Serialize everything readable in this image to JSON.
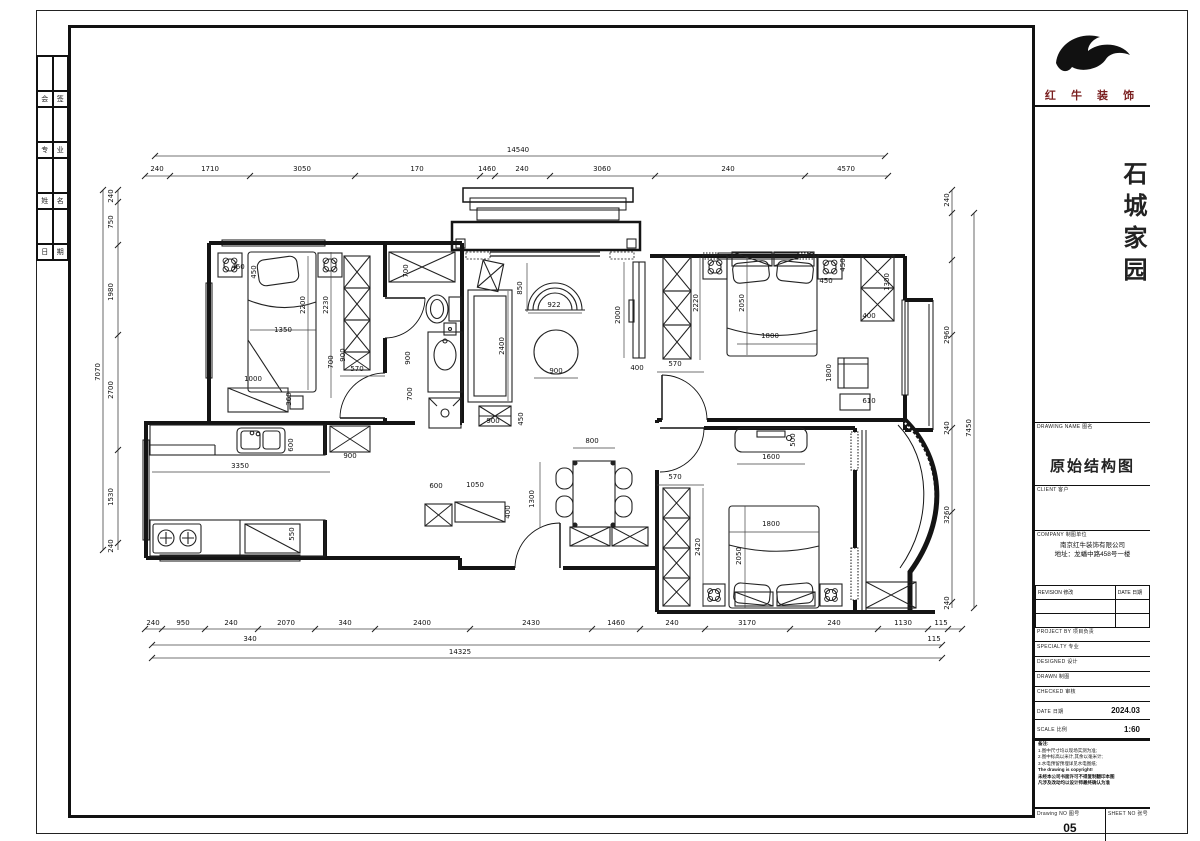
{
  "title_block": {
    "brand": "红 牛 装 饰",
    "project_name": "石城家园",
    "drawing_name_label": "DRAWING NAME 图名",
    "drawing_name": "原始结构图",
    "client_label": "CLIENT 客户",
    "company_label": "COMPANY 制图单位",
    "company_lines": [
      "南京红牛装饰有限公司",
      "地址：龙蟠中路458号一楼"
    ],
    "rev_header_left": "REVISION 修改",
    "rev_header_right": "DATE 日期",
    "info_rows": [
      {
        "label": "PROJECT BY 项目负责"
      },
      {
        "label": "SPECIALTY 专业"
      },
      {
        "label": "DESIGNED 设计"
      },
      {
        "label": "DRAWN 制图"
      },
      {
        "label": "CHECKED 审核"
      }
    ],
    "date_label": "DATE 日期",
    "date_value": "2024.03",
    "scale_label": "SCALE 比例",
    "scale_value": "1:60",
    "notes_lines": [
      "备注:",
      "1.图中尺寸均以现场实测为准;",
      "2.图中标高以米计,其余以毫米计;",
      "3.水电预留预埋详见水电图纸;",
      "The drawing is copyright!",
      "未经本公司书面许可不得复制翻印本图",
      "凡涉及改动均以设计师最终确认为准"
    ],
    "drawing_no_label": "Drawing NO 图号",
    "drawing_no": "05",
    "sheet_no_label": "SHEET NO 张号"
  },
  "binder": {
    "rows": [
      [
        "会",
        "签"
      ],
      [
        "专",
        "业"
      ],
      [
        "姓",
        "名"
      ],
      [
        "日",
        "期"
      ]
    ]
  },
  "plan": {
    "dimensions": [
      {
        "t": "14540",
        "x": 518,
        "y": 152,
        "v": 0
      },
      {
        "t": "240",
        "x": 157,
        "y": 171,
        "v": 0
      },
      {
        "t": "1710",
        "x": 210,
        "y": 171,
        "v": 0
      },
      {
        "t": "3050",
        "x": 302,
        "y": 171,
        "v": 0
      },
      {
        "t": "170",
        "x": 417,
        "y": 171,
        "v": 0
      },
      {
        "t": "1460",
        "x": 487,
        "y": 171,
        "v": 0
      },
      {
        "t": "240",
        "x": 522,
        "y": 171,
        "v": 0
      },
      {
        "t": "3060",
        "x": 602,
        "y": 171,
        "v": 0
      },
      {
        "t": "240",
        "x": 728,
        "y": 171,
        "v": 0
      },
      {
        "t": "4570",
        "x": 846,
        "y": 171,
        "v": 0
      },
      {
        "t": "240",
        "x": 153,
        "y": 625,
        "v": 0
      },
      {
        "t": "950",
        "x": 183,
        "y": 625,
        "v": 0
      },
      {
        "t": "240",
        "x": 231,
        "y": 625,
        "v": 0
      },
      {
        "t": "2070",
        "x": 286,
        "y": 625,
        "v": 0
      },
      {
        "t": "340",
        "x": 345,
        "y": 625,
        "v": 0
      },
      {
        "t": "2400",
        "x": 422,
        "y": 625,
        "v": 0
      },
      {
        "t": "2430",
        "x": 531,
        "y": 625,
        "v": 0
      },
      {
        "t": "1460",
        "x": 616,
        "y": 625,
        "v": 0
      },
      {
        "t": "240",
        "x": 672,
        "y": 625,
        "v": 0
      },
      {
        "t": "3170",
        "x": 747,
        "y": 625,
        "v": 0
      },
      {
        "t": "240",
        "x": 834,
        "y": 625,
        "v": 0
      },
      {
        "t": "1130",
        "x": 903,
        "y": 625,
        "v": 0
      },
      {
        "t": "115",
        "x": 941,
        "y": 625,
        "v": 0
      },
      {
        "t": "340",
        "x": 250,
        "y": 641,
        "v": 0
      },
      {
        "t": "115",
        "x": 934,
        "y": 641,
        "v": 0
      },
      {
        "t": "14325",
        "x": 460,
        "y": 654,
        "v": 0
      },
      {
        "t": "240",
        "x": 113,
        "y": 196,
        "v": 1
      },
      {
        "t": "750",
        "x": 113,
        "y": 222,
        "v": 1
      },
      {
        "t": "1980",
        "x": 113,
        "y": 292,
        "v": 1
      },
      {
        "t": "2700",
        "x": 113,
        "y": 390,
        "v": 1
      },
      {
        "t": "1530",
        "x": 113,
        "y": 497,
        "v": 1
      },
      {
        "t": "240",
        "x": 113,
        "y": 546,
        "v": 1
      },
      {
        "t": "7070",
        "x": 100,
        "y": 372,
        "v": 1
      },
      {
        "t": "240",
        "x": 949,
        "y": 200,
        "v": 1
      },
      {
        "t": "2960",
        "x": 949,
        "y": 335,
        "v": 1
      },
      {
        "t": "240",
        "x": 949,
        "y": 428,
        "v": 1
      },
      {
        "t": "3260",
        "x": 949,
        "y": 515,
        "v": 1
      },
      {
        "t": "240",
        "x": 949,
        "y": 603,
        "v": 1
      },
      {
        "t": "7450",
        "x": 971,
        "y": 428,
        "v": 1
      },
      {
        "t": "460",
        "x": 238,
        "y": 269,
        "v": 0
      },
      {
        "t": "450",
        "x": 256,
        "y": 272,
        "v": 1
      },
      {
        "t": "1350",
        "x": 283,
        "y": 332,
        "v": 0
      },
      {
        "t": "2200",
        "x": 305,
        "y": 305,
        "v": 1
      },
      {
        "t": "2230",
        "x": 328,
        "y": 305,
        "v": 1
      },
      {
        "t": "570",
        "x": 357,
        "y": 371,
        "v": 0
      },
      {
        "t": "1000",
        "x": 253,
        "y": 381,
        "v": 0
      },
      {
        "t": "360",
        "x": 291,
        "y": 399,
        "v": 1
      },
      {
        "t": "700",
        "x": 333,
        "y": 362,
        "v": 1
      },
      {
        "t": "900",
        "x": 345,
        "y": 355,
        "v": 1
      },
      {
        "t": "700",
        "x": 408,
        "y": 271,
        "v": 1
      },
      {
        "t": "900",
        "x": 410,
        "y": 358,
        "v": 1
      },
      {
        "t": "700",
        "x": 412,
        "y": 394,
        "v": 1
      },
      {
        "t": "850",
        "x": 522,
        "y": 288,
        "v": 1
      },
      {
        "t": "922",
        "x": 554,
        "y": 307,
        "v": 0
      },
      {
        "t": "900",
        "x": 556,
        "y": 373,
        "v": 0
      },
      {
        "t": "2400",
        "x": 504,
        "y": 346,
        "v": 1
      },
      {
        "t": "900",
        "x": 493,
        "y": 423,
        "v": 0
      },
      {
        "t": "450",
        "x": 523,
        "y": 419,
        "v": 1
      },
      {
        "t": "2000",
        "x": 620,
        "y": 315,
        "v": 1
      },
      {
        "t": "400",
        "x": 637,
        "y": 370,
        "v": 0
      },
      {
        "t": "570",
        "x": 675,
        "y": 366,
        "v": 0
      },
      {
        "t": "2220",
        "x": 698,
        "y": 303,
        "v": 1
      },
      {
        "t": "2050",
        "x": 744,
        "y": 303,
        "v": 1
      },
      {
        "t": "1800",
        "x": 770,
        "y": 338,
        "v": 0
      },
      {
        "t": "450",
        "x": 826,
        "y": 283,
        "v": 0
      },
      {
        "t": "450",
        "x": 845,
        "y": 265,
        "v": 1
      },
      {
        "t": "1300",
        "x": 889,
        "y": 282,
        "v": 1
      },
      {
        "t": "400",
        "x": 869,
        "y": 318,
        "v": 0
      },
      {
        "t": "1800",
        "x": 831,
        "y": 373,
        "v": 1
      },
      {
        "t": "610",
        "x": 869,
        "y": 403,
        "v": 0
      },
      {
        "t": "500",
        "x": 795,
        "y": 440,
        "v": 1
      },
      {
        "t": "1600",
        "x": 771,
        "y": 459,
        "v": 0
      },
      {
        "t": "1800",
        "x": 771,
        "y": 526,
        "v": 0
      },
      {
        "t": "2050",
        "x": 741,
        "y": 556,
        "v": 1
      },
      {
        "t": "2420",
        "x": 700,
        "y": 547,
        "v": 1
      },
      {
        "t": "570",
        "x": 675,
        "y": 479,
        "v": 0
      },
      {
        "t": "3350",
        "x": 240,
        "y": 468,
        "v": 0
      },
      {
        "t": "600",
        "x": 293,
        "y": 445,
        "v": 1
      },
      {
        "t": "550",
        "x": 294,
        "y": 534,
        "v": 1
      },
      {
        "t": "900",
        "x": 350,
        "y": 458,
        "v": 0
      },
      {
        "t": "600",
        "x": 436,
        "y": 488,
        "v": 0
      },
      {
        "t": "1050",
        "x": 475,
        "y": 487,
        "v": 0
      },
      {
        "t": "400",
        "x": 510,
        "y": 512,
        "v": 1
      },
      {
        "t": "1300",
        "x": 534,
        "y": 499,
        "v": 1
      },
      {
        "t": "800",
        "x": 592,
        "y": 443,
        "v": 0
      }
    ]
  }
}
